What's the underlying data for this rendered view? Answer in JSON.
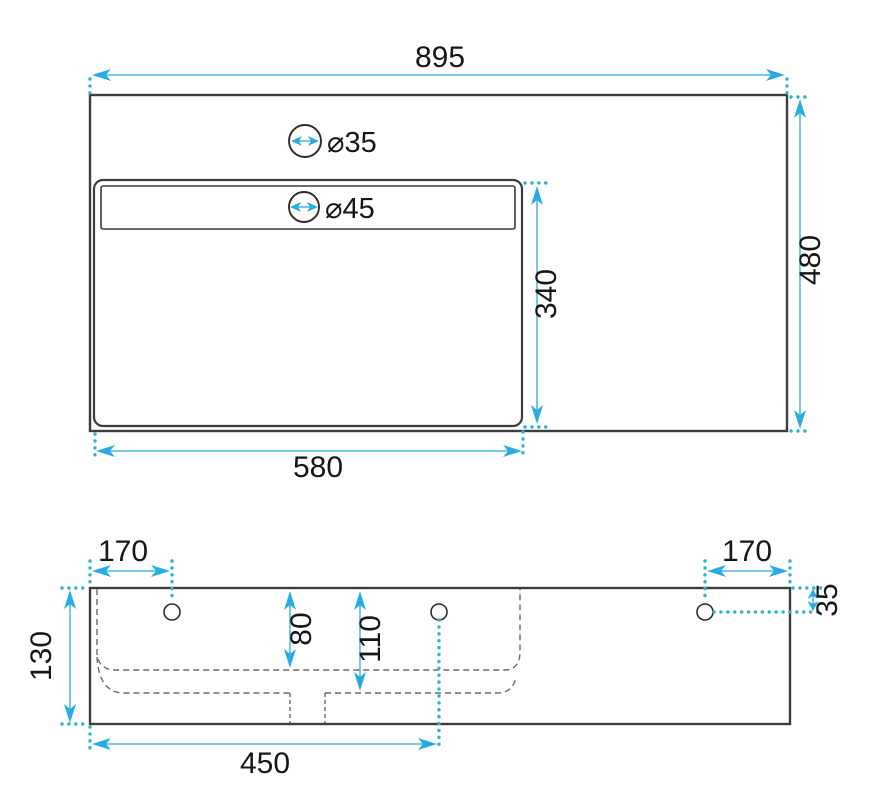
{
  "drawing": {
    "kind": "washbasin-dimension-drawing",
    "colors": {
      "dimension_arrow": "#29abe2",
      "extension_dots": "#2eb6c8",
      "outline": "#3c3c3c",
      "hidden_line": "#6a6a6a",
      "label_text": "#161616",
      "background": "#ffffff"
    },
    "top_view": {
      "overall_width": "895",
      "overall_depth": "480",
      "basin_width": "580",
      "basin_depth": "340",
      "faucet_hole_diameter": "⌀35",
      "overflow_hole_diameter": "⌀45"
    },
    "front_view": {
      "left_hole_inset": "170",
      "right_hole_inset": "170",
      "hole_drop_from_top": "35",
      "total_height": "130",
      "basin_inner_depth": "80",
      "basin_outer_depth": "110",
      "drain_center_from_left": "450"
    }
  }
}
